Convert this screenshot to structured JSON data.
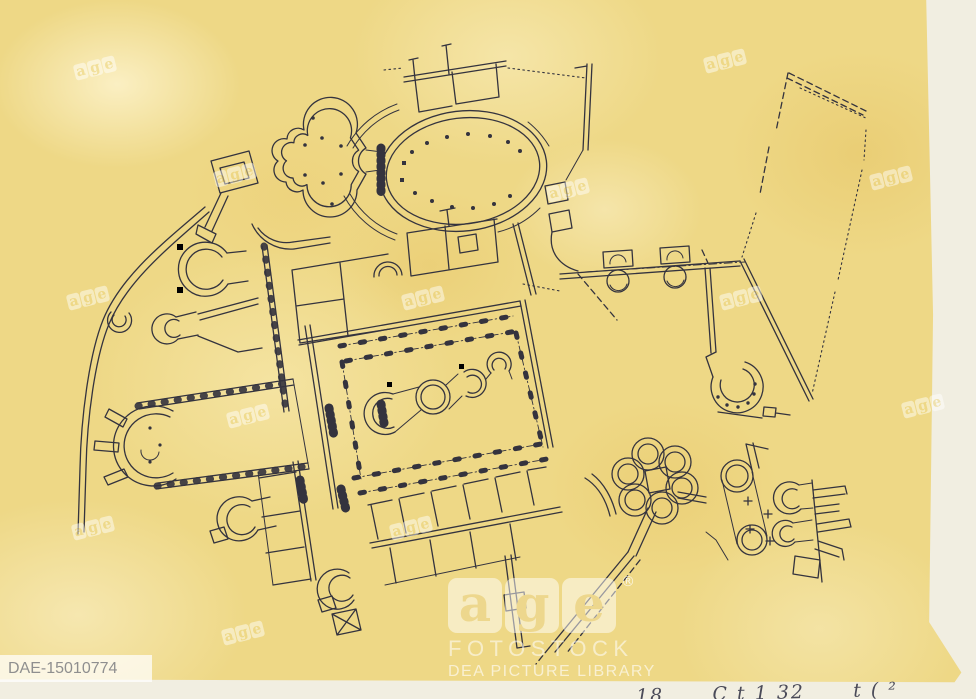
{
  "scan": {
    "description": "Ink floor plan of a Roman bath complex drawn on mottled yellow paper",
    "catalog_id": "DAE-15010774",
    "handwritten_note": "18      C t 1 32      t ( ²",
    "paper_color": "#eed886",
    "ink_color": "#34333e"
  },
  "watermark": {
    "letters": [
      "a",
      "g",
      "e"
    ],
    "registered_mark": "®",
    "brand_line": "FOTOSTOCK",
    "library_line": "DEA PICTURE LIBRARY",
    "small_mark_count": 13
  }
}
